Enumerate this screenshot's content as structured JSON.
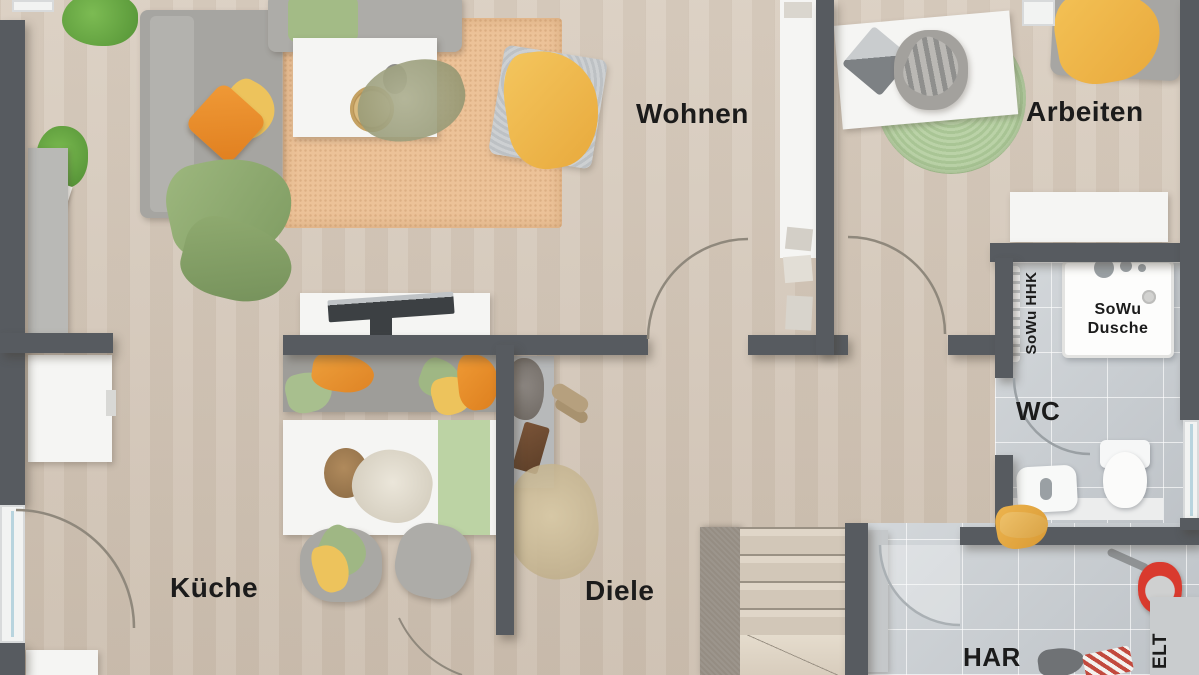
{
  "labels": {
    "wohnen": "Wohnen",
    "arbeiten": "Arbeiten",
    "kueche": "Küche",
    "diele": "Diele",
    "wc": "WC",
    "har": "HAR",
    "elt": "ELT",
    "sowu_hhk": "SoWu HHK",
    "sowu_dusche_line1": "SoWu",
    "sowu_dusche_line2": "Dusche"
  },
  "colors": {
    "wall": "#575b60",
    "floor_wood": "#d6c9ba",
    "floor_tile": "#cbd0d4",
    "rug_orange": "#ecc298",
    "rug_green": "#b1cb9d",
    "accent_orange": "#ec8f2d",
    "accent_yellow": "#f0bb52",
    "accent_green": "#8fac72",
    "bucket_red": "#d93a2e",
    "furniture_white": "#f5f5f3",
    "furniture_gray": "#a6a5a1",
    "label_text": "#1b1b1b"
  },
  "furniture": [
    "sofa",
    "chaise-longue",
    "coffee-table",
    "decor-tray",
    "area-rug",
    "ottoman",
    "yellow-blanket",
    "green-blanket",
    "cushions",
    "palm-plant",
    "fern-plant",
    "sideboard",
    "media-desk",
    "laptop",
    "kitchen-bench",
    "dining-table",
    "centerpiece-bowl",
    "table-runner",
    "dining-chairs",
    "refrigerator",
    "hall-sideboard",
    "shoes",
    "pampas-plant",
    "staircase",
    "bookshelf",
    "work-desk",
    "office-chair",
    "round-rug",
    "daybed",
    "lowboard",
    "towel-radiator",
    "shower-tray",
    "toilet",
    "washbasin",
    "towel",
    "mop-bucket",
    "cleaning-rag",
    "utility-door",
    "electrical-cabinet"
  ]
}
